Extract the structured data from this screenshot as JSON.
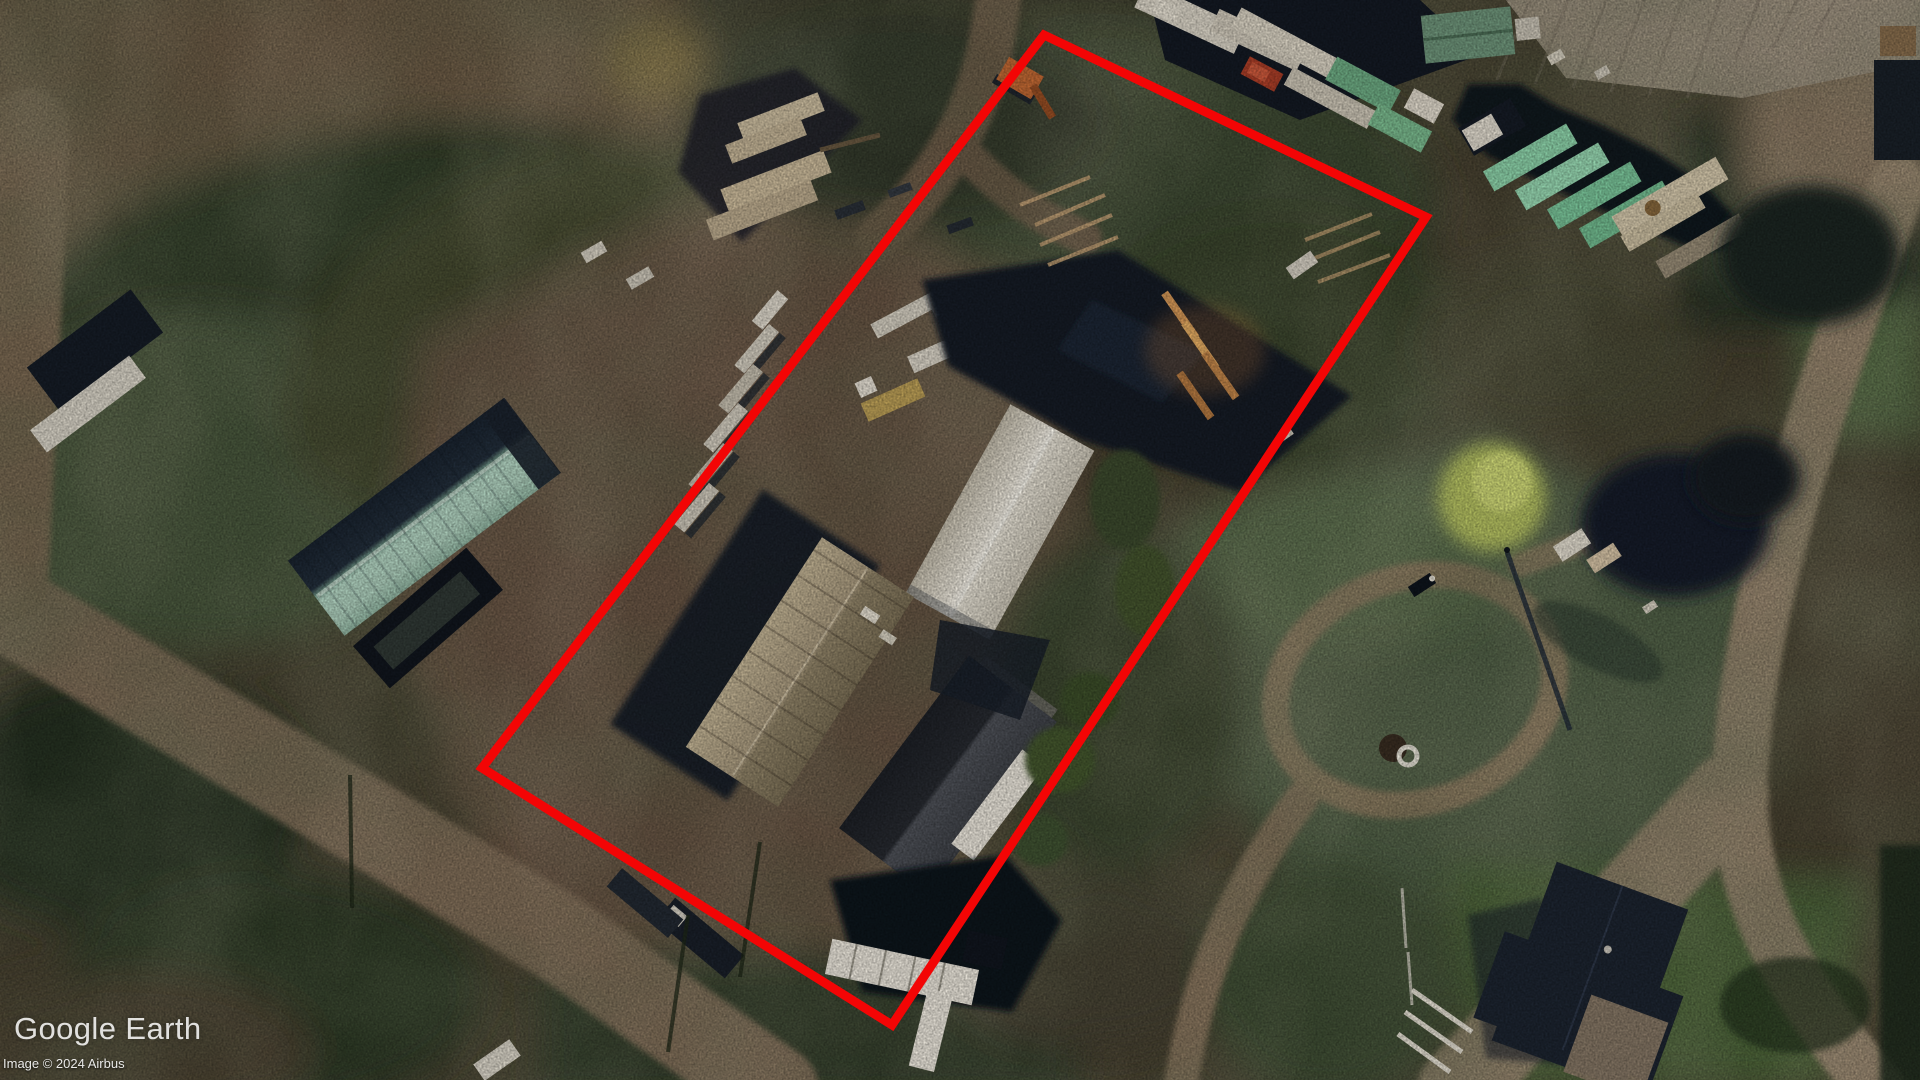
{
  "watermark": {
    "text": "Google Earth",
    "color": "rgba(255,255,255,0.85)"
  },
  "attribution": {
    "text": "Image © 2024 Airbus",
    "color": "rgba(255,255,255,0.9)"
  },
  "annotation": {
    "label": "highlighted-parcel-boundary",
    "color": "#F30505",
    "stroke_width": 9,
    "points": "1044,35 1426,217 892,1025 482,768"
  },
  "scene": {
    "type": "aerial-imagery",
    "palette": {
      "ground": "#494231",
      "dirt_yard": "#6B5745",
      "road_tan": "#9A8870",
      "vegetation_dark": "#31402B",
      "grass_field": "#53644A",
      "container_teal": "#8FD6AC",
      "seafoam_roof": "#B6D9C6",
      "white_roof": "#EFEADF",
      "dark_roof": "#1D2531"
    }
  }
}
